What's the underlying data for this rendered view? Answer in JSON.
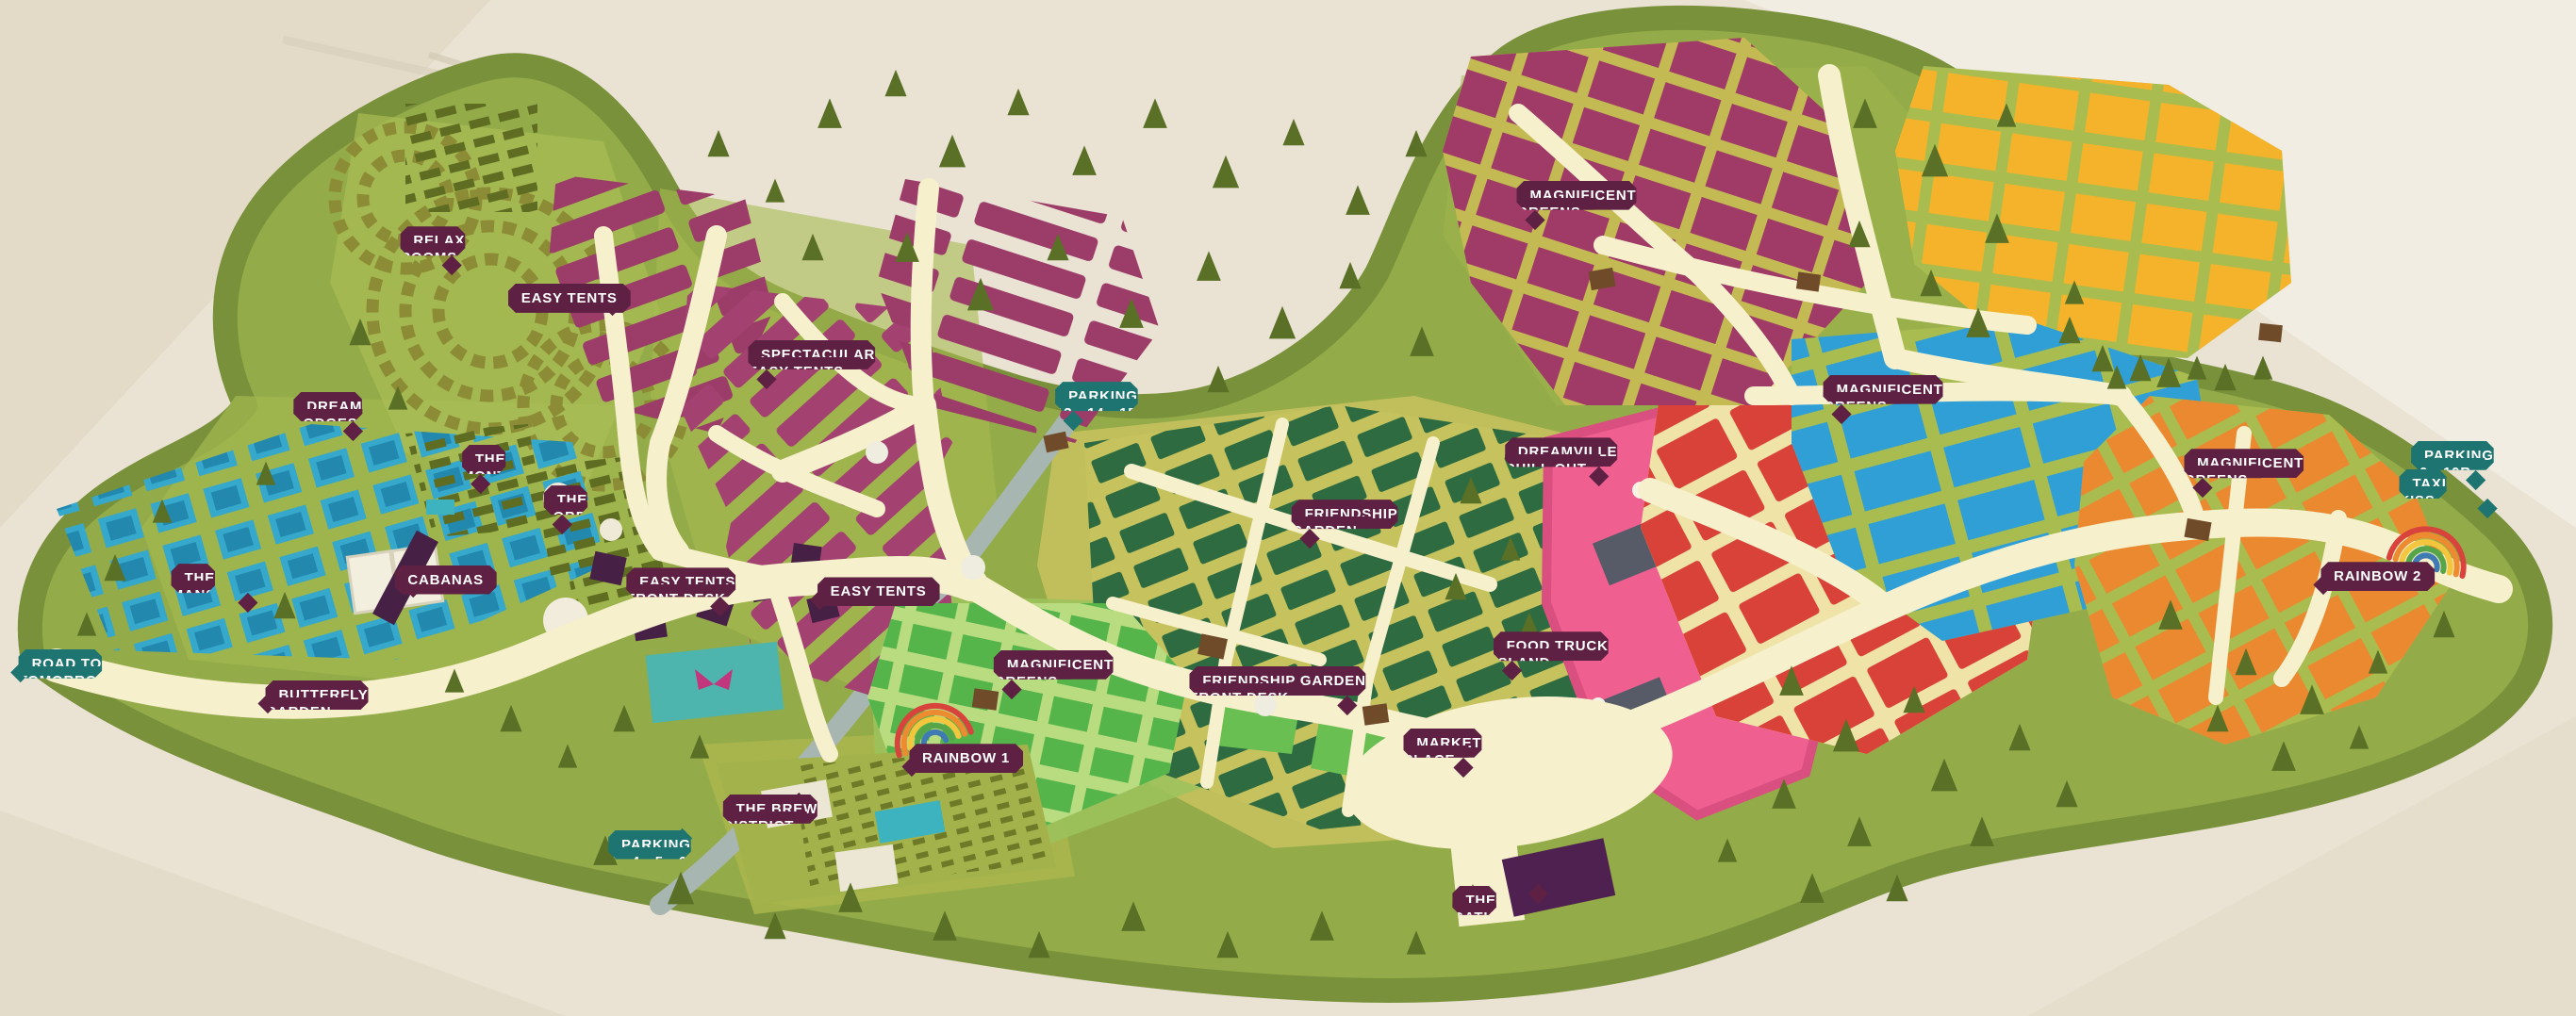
{
  "map": {
    "kind": "festival-campsite-illustrated-map",
    "palette": {
      "paper": "#eae3d3",
      "paper_light": "#f3efe4",
      "grass": "#93ab48",
      "grass_rim": "#79913b",
      "path_cream": "#f7f0cd",
      "area_badge": "#5e2143",
      "transport_badge": "#1e7470",
      "easy_tents_purple": "#9c3c68",
      "dream_lodges_blue": "#35a8cb",
      "friendship_green": "#2e6b40",
      "magnificent_bright_green": "#55b54b",
      "red_zone": "#d94238",
      "magenta_zone": "#a03a67",
      "yellow_zone": "#f5b32b",
      "blue_zone": "#2f9fd6",
      "orange_zone": "#ea8930",
      "chill_out_pink": "#ef6090",
      "road_grey": "#a7b6b0",
      "tree_green": "#5a7026"
    },
    "labels": [
      {
        "id": "relax-rooms",
        "text": "RELAX\nROOMS",
        "type": "area",
        "x": 16.9,
        "y": 24.6,
        "pointer": "p-br"
      },
      {
        "id": "easy-tents-1",
        "text": "EASY TENTS",
        "type": "area",
        "x": 22.1,
        "y": 29.4,
        "pointer": "p-br"
      },
      {
        "id": "dream-lodges",
        "text": "DREAM\nLODGES",
        "type": "area",
        "x": 12.9,
        "y": 40.9,
        "pointer": "p-br"
      },
      {
        "id": "spectacular-easy-tents",
        "text": "SPECTACULAR\nEASY TENTS",
        "type": "area",
        "x": 31.5,
        "y": 35.8,
        "pointer": "p-bl"
      },
      {
        "id": "the-montagoe",
        "text": "THE\nMONTAGOE",
        "type": "area",
        "x": 19.9,
        "y": 46.1,
        "pointer": "p-bl"
      },
      {
        "id": "the-lobby",
        "text": "THE\nLOBBY",
        "type": "area",
        "x": 22.4,
        "y": 50.1,
        "pointer": "p-bl"
      },
      {
        "id": "cabanas",
        "text": "CABANAS",
        "type": "area",
        "x": 17.3,
        "y": 57.1,
        "pointer": "p-bl"
      },
      {
        "id": "easy-tents-front-desk",
        "text": "EASY TENTS\nFRONT DESK",
        "type": "area",
        "x": 26.5,
        "y": 58.2,
        "pointer": "p-br"
      },
      {
        "id": "easy-tents-2",
        "text": "EASY TENTS",
        "type": "area",
        "x": 34.1,
        "y": 58.3,
        "pointer": "p-tl"
      },
      {
        "id": "the-mansions",
        "text": "THE\nMANSIONS",
        "type": "area",
        "x": 8.5,
        "y": 57.8,
        "pointer": "p-br"
      },
      {
        "id": "road-to-tomorrowland",
        "text": "ROAD TO\nTOMORROWLAND",
        "type": "transport",
        "x": 3.6,
        "y": 66.2,
        "pointer": "p-tl"
      },
      {
        "id": "butterfly-garden",
        "text": "BUTTERFLY\nGARDEN",
        "type": "area",
        "x": 12.3,
        "y": 69.3,
        "pointer": "p-tl"
      },
      {
        "id": "parking-13-14-15",
        "text": "PARKING\n13 - 14 - 15",
        "type": "transport",
        "x": 42.8,
        "y": 39.9,
        "pointer": "p-bl"
      },
      {
        "id": "magnificent-greens-1",
        "text": "MAGNIFICENT\nGREENS",
        "type": "area",
        "x": 40.9,
        "y": 66.3,
        "pointer": "p-bl"
      },
      {
        "id": "rainbow-1",
        "text": "RAINBOW 1",
        "type": "area",
        "x": 37.5,
        "y": 74.7,
        "pointer": "p-tl"
      },
      {
        "id": "the-brew-district",
        "text": "THE BREW\nDISTRICT",
        "type": "area",
        "x": 29.9,
        "y": 80.5,
        "pointer": "p-tr"
      },
      {
        "id": "parking-3-4-5-6",
        "text": "PARKING\n3 - 4 - 5 - 6",
        "type": "transport",
        "x": 25.4,
        "y": 84.0,
        "pointer": "p-tr"
      },
      {
        "id": "friendship-garden",
        "text": "FRIENDSHIP\nGARDEN",
        "type": "area",
        "x": 52.2,
        "y": 51.5,
        "pointer": "p-bl"
      },
      {
        "id": "friendship-garden-front-desk",
        "text": "FRIENDSHIP GARDEN\nFRONT DESK",
        "type": "area",
        "x": 49.6,
        "y": 67.9,
        "pointer": "p-br"
      },
      {
        "id": "dreamville-chill-out",
        "text": "DREAMVILLE\nCHILL OUT",
        "type": "area",
        "x": 60.6,
        "y": 45.4,
        "pointer": "p-br"
      },
      {
        "id": "food-truck-island",
        "text": "FOOD TRUCK\nISLAND",
        "type": "area",
        "x": 60.2,
        "y": 64.5,
        "pointer": "p-bl"
      },
      {
        "id": "market-place",
        "text": "MARKET\nPLACE",
        "type": "area",
        "x": 56.0,
        "y": 74.0,
        "pointer": "p-br"
      },
      {
        "id": "the-gathering",
        "text": "THE\nGATHERING",
        "type": "area",
        "x": 58.4,
        "y": 89.5,
        "pointer": "p-tr"
      },
      {
        "id": "magnificent-greens-2",
        "text": "MAGNIFICENT\nGREENS",
        "type": "area",
        "x": 61.2,
        "y": 20.1,
        "pointer": "p-bl"
      },
      {
        "id": "magnificent-greens-3",
        "text": "MAGNIFICENT\nGREENS",
        "type": "area",
        "x": 73.1,
        "y": 39.2,
        "pointer": "p-bl"
      },
      {
        "id": "magnificent-greens-4",
        "text": "MAGNIFICENT\nGREENS",
        "type": "area",
        "x": 87.1,
        "y": 46.5,
        "pointer": "p-bl"
      },
      {
        "id": "parking-10-10b",
        "text": "PARKING\n10 - 10B",
        "type": "transport",
        "x": 95.2,
        "y": 45.7,
        "pointer": "p-br"
      },
      {
        "id": "taxi-kiss-ride",
        "text": "TAXI\nKISS & RIDE",
        "type": "transport",
        "x": 95.2,
        "y": 48.5,
        "pointer": "p-br"
      },
      {
        "id": "rainbow-2",
        "text": "RAINBOW 2",
        "type": "area",
        "x": 92.3,
        "y": 56.8,
        "pointer": "p-tl"
      }
    ]
  }
}
